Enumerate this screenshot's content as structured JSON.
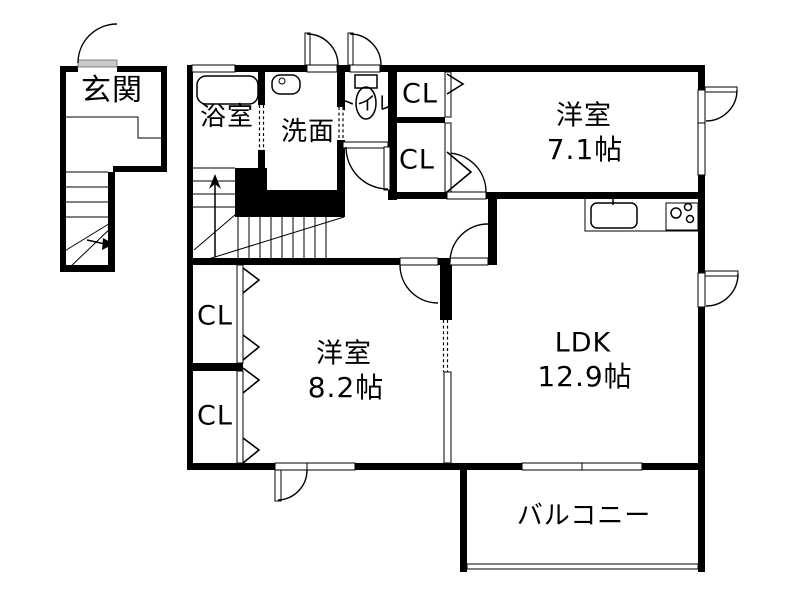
{
  "floorplan": {
    "rooms": {
      "genkan": {
        "label": "玄関"
      },
      "bathroom": {
        "label": "浴室"
      },
      "washroom": {
        "label": "洗面"
      },
      "toilet": {
        "label": "トイレ"
      },
      "closet_top": {
        "label": "CL"
      },
      "closet_mid": {
        "label": "CL"
      },
      "bedroom1": {
        "label": "洋室",
        "size": "7.1帖"
      },
      "closet_left_upper": {
        "label": "CL"
      },
      "closet_left_lower": {
        "label": "CL"
      },
      "bedroom2": {
        "label": "洋室",
        "size": "8.2帖"
      },
      "ldk": {
        "label": "LDK",
        "size": "12.9帖"
      },
      "balcony": {
        "label": "バルコニー"
      }
    },
    "colors": {
      "wall": "#000000",
      "floor": "#ffffff",
      "door_leaf": "#c9c9c9"
    }
  }
}
